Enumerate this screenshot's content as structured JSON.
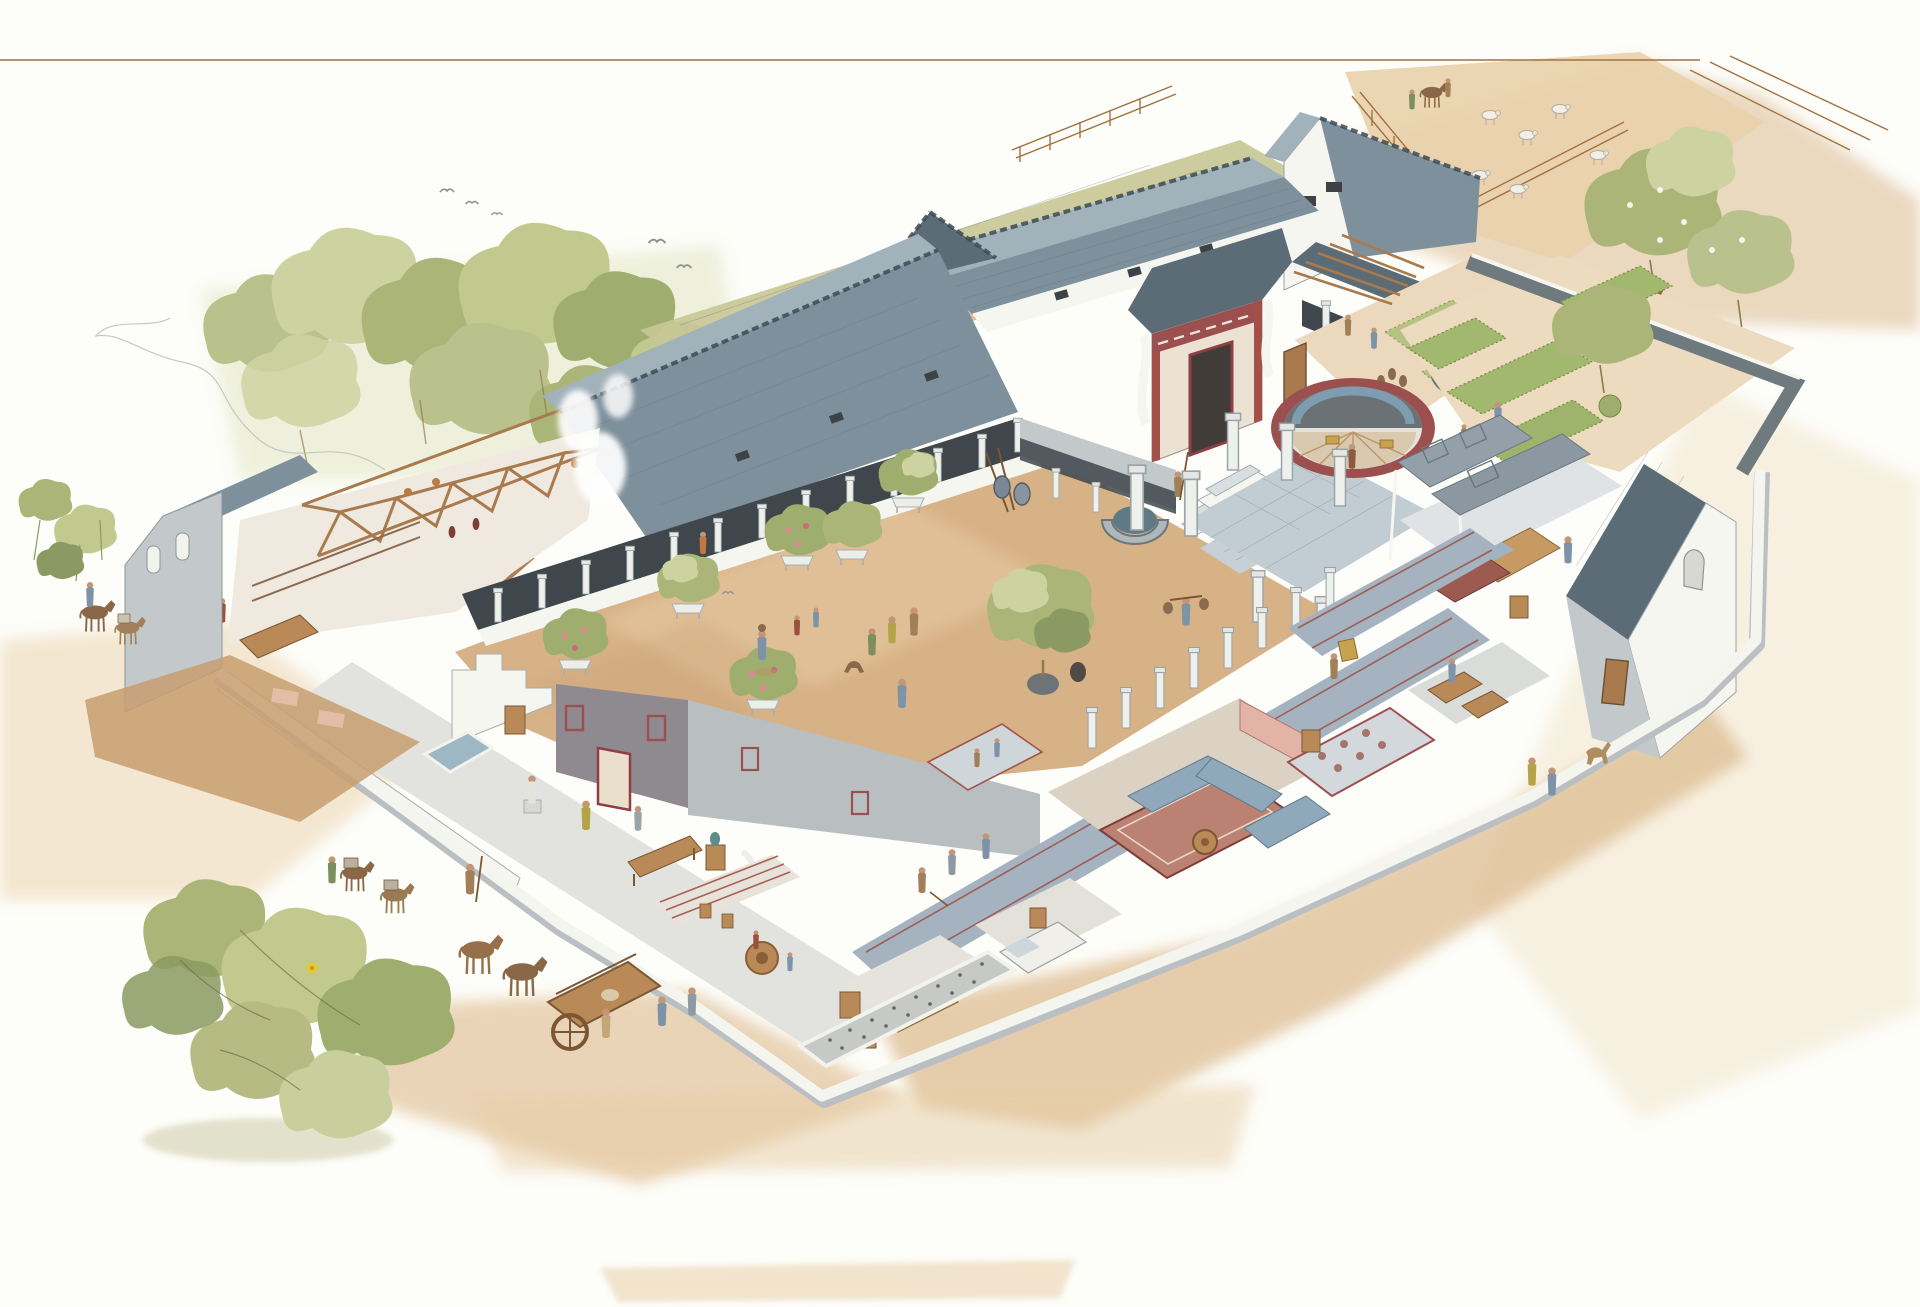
{
  "illustration": {
    "aria_label": "Cutaway watercolor reconstruction of a Roman courtyard villa with farm courtyard, kitchens, formal gardens, bath suite, horse cart and many small figures"
  },
  "palette": {
    "paper": "#fdfdf9",
    "roof": "#7e909c",
    "roof_light": "#a2b2bb",
    "roof_dark": "#5b6c77",
    "ridge": "#3d4b54",
    "wall": "#f6f6f1",
    "wall_shade": "#c3c9cb",
    "veranda": "#40474c",
    "courtyard": "#d8b287",
    "courtyard_light": "#e7cba4",
    "road": "#d9bb92",
    "wash": "#e2c49c",
    "grass": "#c6c795",
    "foliage": "#aab577",
    "foliage_light": "#cdd3a0",
    "foliage_dark": "#8a9a62",
    "hedge": "#a3b86f",
    "lawn": "#b7c383",
    "water": "#5d7a86",
    "corridor_floor": "#a4b3bf",
    "stripe_red": "#a05348",
    "fresco": "#9c4f4f",
    "fresco_pink": "#e3b3a8",
    "timber": "#a87a4e",
    "furniture": "#b98a57",
    "couch": "#8fa9ba",
    "pebble": "#c6c9c6",
    "skin": "#c49576",
    "shadow": "#c79e74"
  }
}
